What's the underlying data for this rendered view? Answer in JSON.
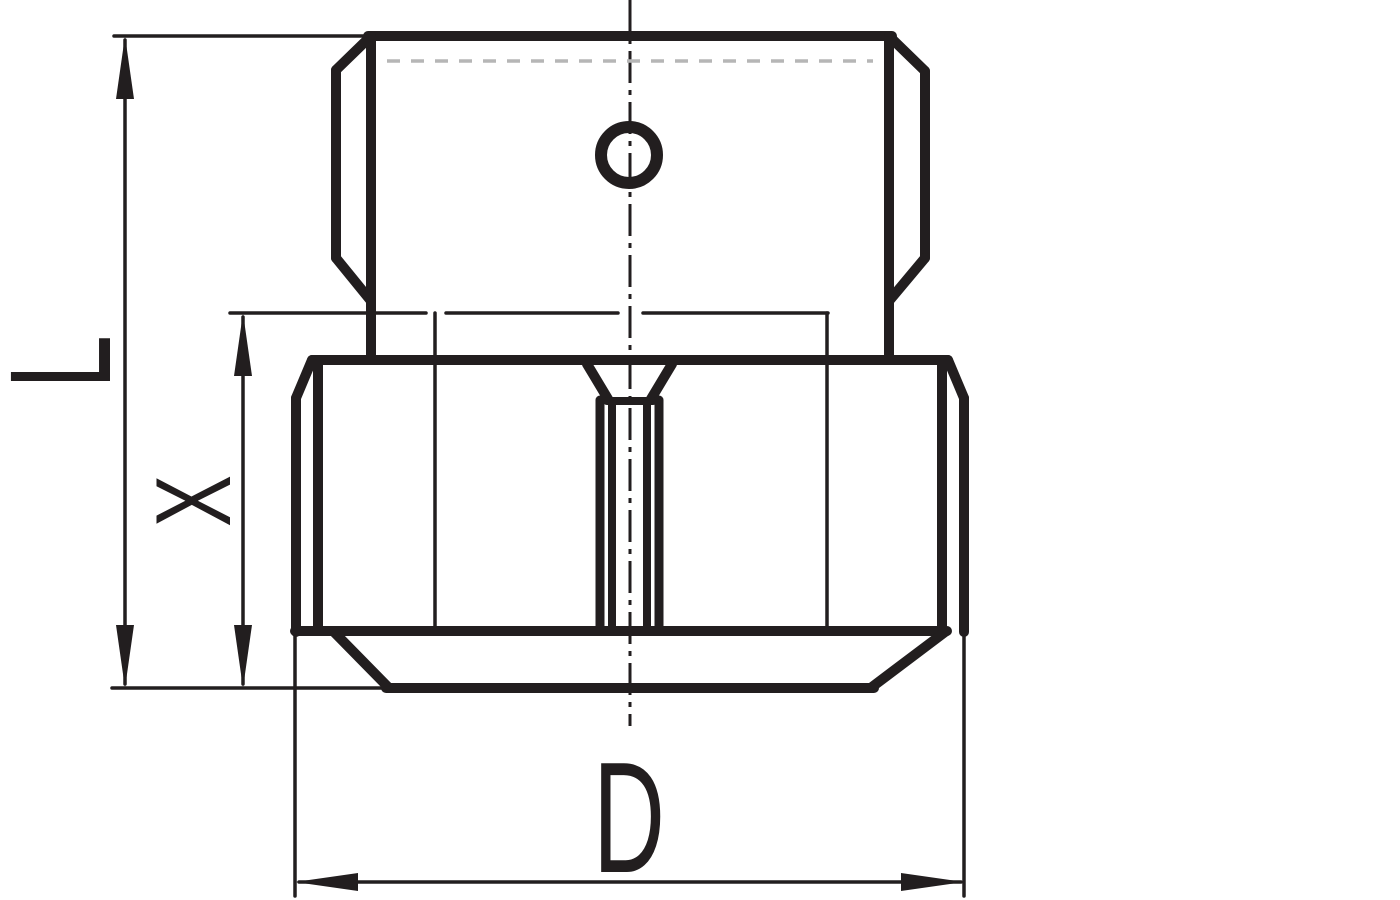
{
  "drawing": {
    "background_color": "#ffffff",
    "ink_color": "#221e1f",
    "hidden_line_color": "#b6b6b6",
    "dimension_labels": {
      "overall_height": "L",
      "lower_section_height": "X",
      "overall_width": "D"
    }
  }
}
